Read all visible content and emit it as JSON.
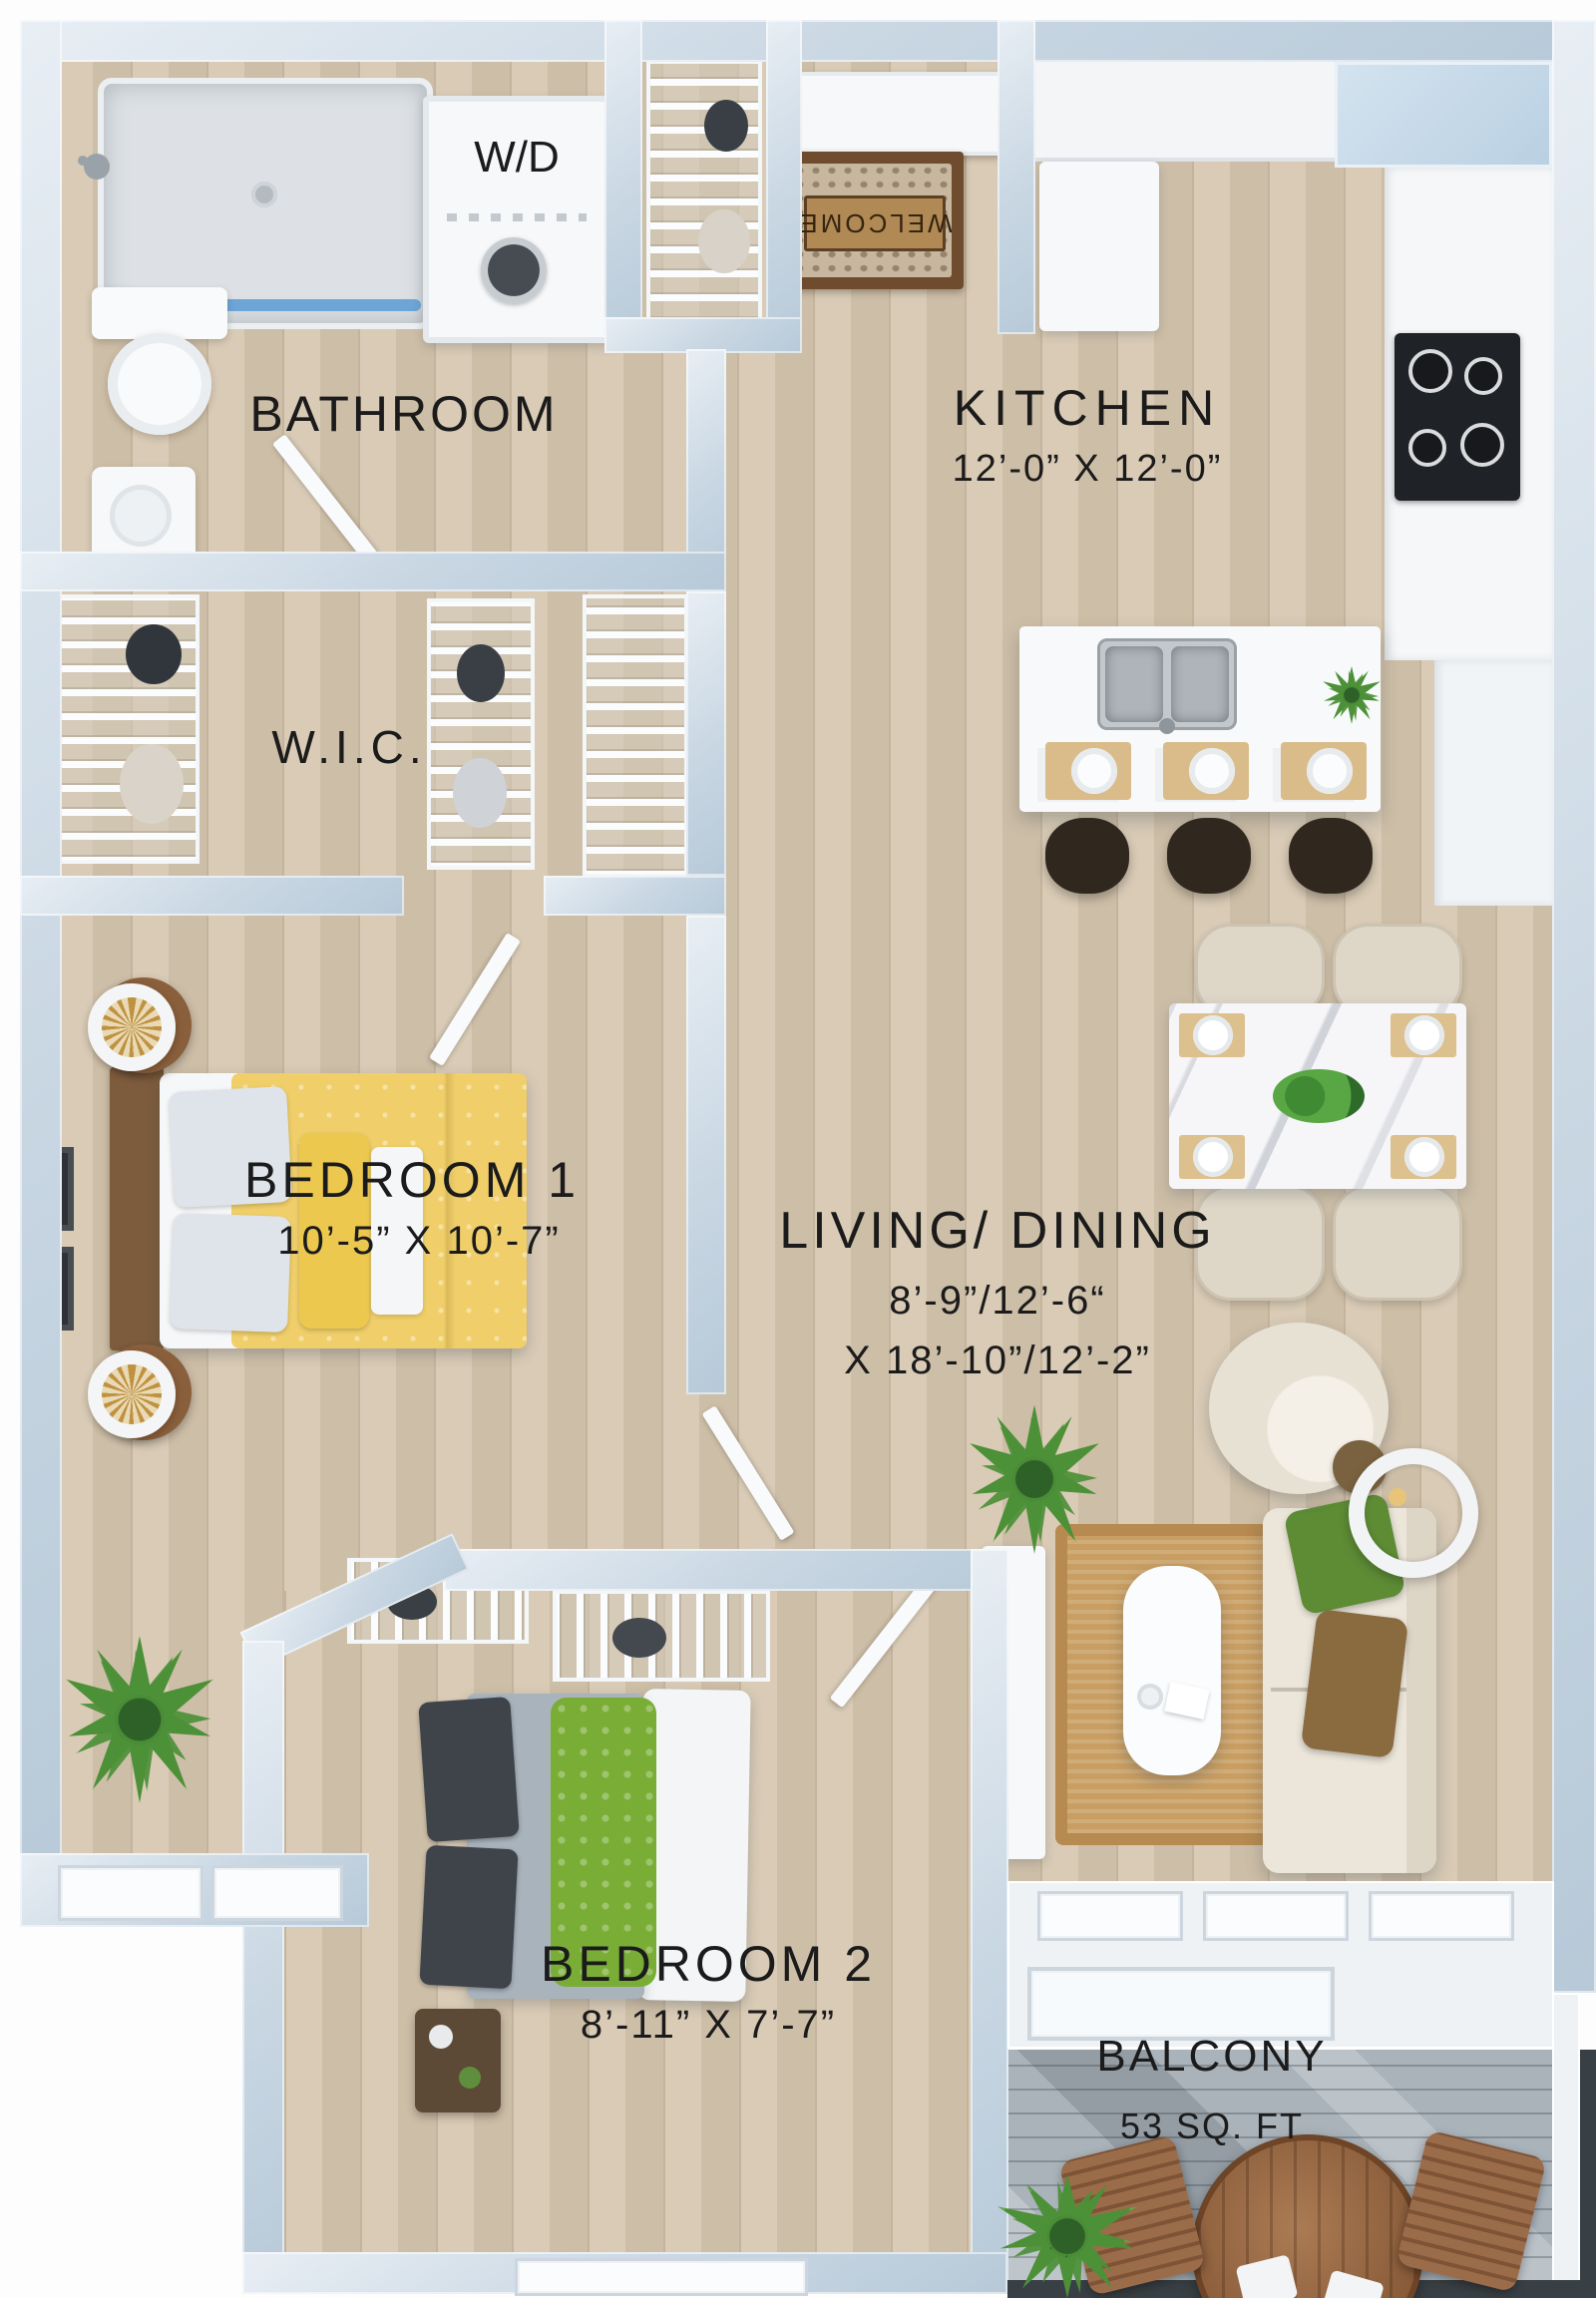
{
  "floorplan": {
    "rooms": {
      "bathroom": {
        "label": "BATHROOM"
      },
      "laundry": {
        "label": "W/D"
      },
      "wic": {
        "label": "W.I.C."
      },
      "kitchen": {
        "label": "KITCHEN",
        "dims": "12’-0” X 12’-0”"
      },
      "bedroom1": {
        "label": "BEDROOM 1",
        "dims": "10’-5” X 10’-7”"
      },
      "living": {
        "label": "LIVING/ DINING",
        "dims_line1": "8’-9”/12’-6“",
        "dims_line2": "X 18’-10”/12’-2”"
      },
      "bedroom2": {
        "label": "BEDROOM 2",
        "dims": "8’-11” X 7’-7”"
      },
      "balcony": {
        "label": "BALCONY",
        "area": "53 SQ. FT"
      }
    },
    "entry": {
      "mat_text": "WELCOME"
    },
    "colors": {
      "wall": "#c9d7e3",
      "wall_highlight": "#eef2f5",
      "wood_floor": "#d6c7b0",
      "balcony_floor": "#aab3ba",
      "bed1_accent": "#f0cf6a",
      "label_text": "#1b1b1b"
    }
  }
}
